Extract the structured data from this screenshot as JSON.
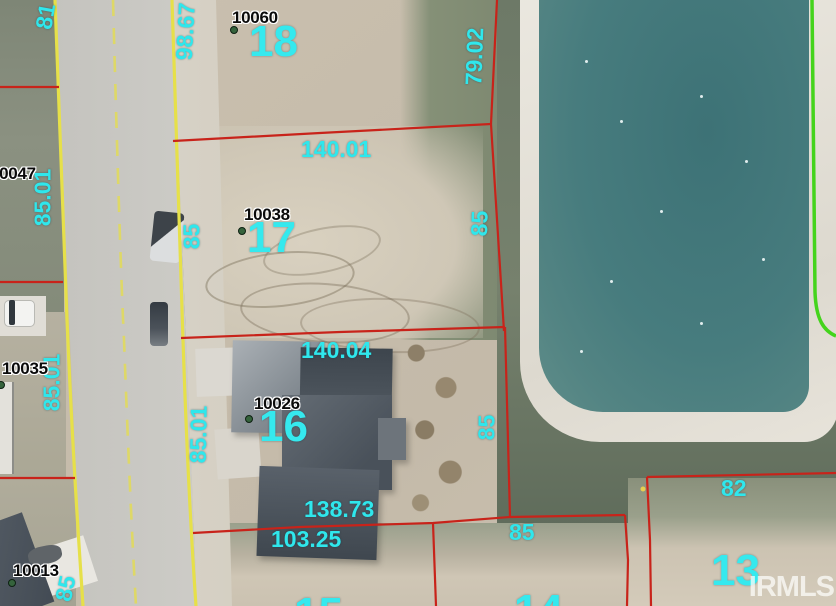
{
  "map": {
    "type": "aerial-parcel-map",
    "watermark": "IRMLS",
    "colors": {
      "boundary_red": "#c8231a",
      "road_edge_yellow": "#e6e049",
      "easement_green": "#44d41c",
      "label_cyan": "#2fe7ec",
      "parcel_id_black": "#0a0a0a",
      "pond_water": "#44787b"
    },
    "lot_numbers": {
      "lot18": "18",
      "lot17": "17",
      "lot16": "16",
      "lot13": "13",
      "lot15_partial": "15",
      "lot14_partial": "14"
    },
    "parcel_ids": {
      "p10060": "10060",
      "p10038": "10038",
      "p10026": "10026",
      "p10035": "10035",
      "p10013": "10013",
      "p00047": "00047"
    },
    "dimensions": {
      "d81": "81",
      "d98_67": "98.67",
      "d79_02": "79.02",
      "d85_01_top": "85.01",
      "d85_lot17_left": "85",
      "d140_01": "140.01",
      "d85_lot17_right": "85",
      "d85_01_mid": "85.01",
      "d140_04": "140.04",
      "d85_01_lot16": "85.01",
      "d85_lot16_right": "85",
      "d138_73": "138.73",
      "d103_25": "103.25",
      "d85_bottom": "85",
      "d82": "82",
      "d85_lot13": "85"
    }
  }
}
